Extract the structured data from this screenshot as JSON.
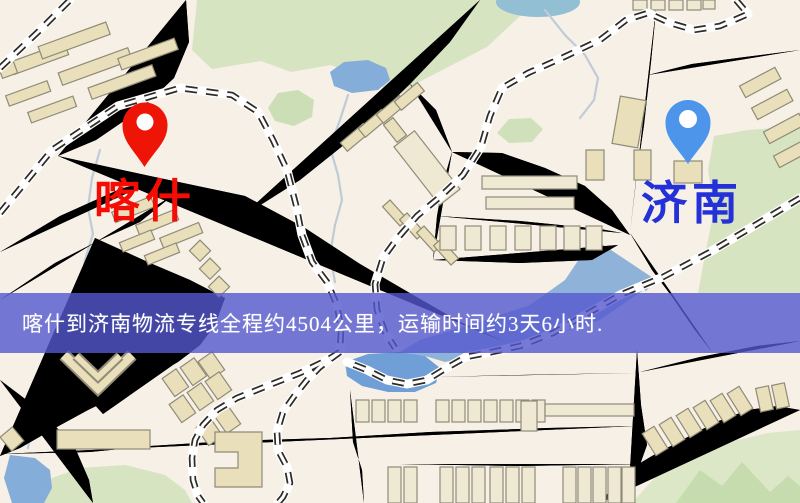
{
  "map": {
    "origin": {
      "name": "喀什",
      "pin_icon": "red-map-pin",
      "pin_color": "#ee1506",
      "label_color": "#f50d05"
    },
    "destination": {
      "name": "济南",
      "pin_icon": "blue-map-pin",
      "pin_color": "#4d95ea",
      "label_color": "#2430d8"
    },
    "banner": {
      "text": "喀什到济南物流专线全程约4504公里，运输时间约3天6小时.",
      "background_color": "#5458ce",
      "text_color": "#ffffff",
      "distance_km": 4504,
      "transit_time": "3天6小时"
    },
    "palette": {
      "land": "#f6f0e7",
      "road": "#f6d169",
      "road_casing": "#e2b45e",
      "park_green": "#d7e4c2",
      "water_blue": "#84add9",
      "railway_black": "#2f2b27",
      "building_tan": "#e9dfba"
    }
  }
}
